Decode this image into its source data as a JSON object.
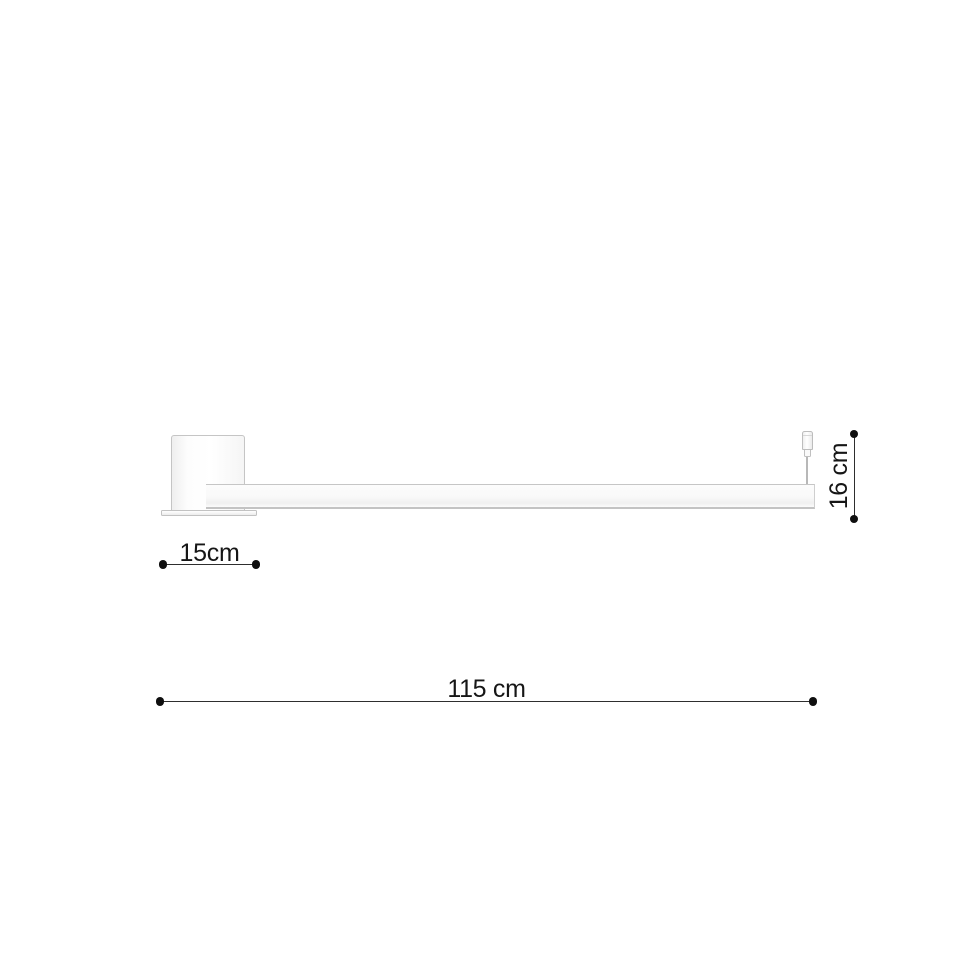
{
  "diagram": {
    "labels": {
      "plate_width": "15cm",
      "fixture_height": "16 cm",
      "fixture_length": "115 cm"
    },
    "colors": {
      "background": "#ffffff",
      "fixture_outline": "#c5c5c5",
      "dimension_line": "#2e2e2e",
      "endpoint_dot": "#0f0f0f",
      "label_text": "#161616"
    }
  }
}
